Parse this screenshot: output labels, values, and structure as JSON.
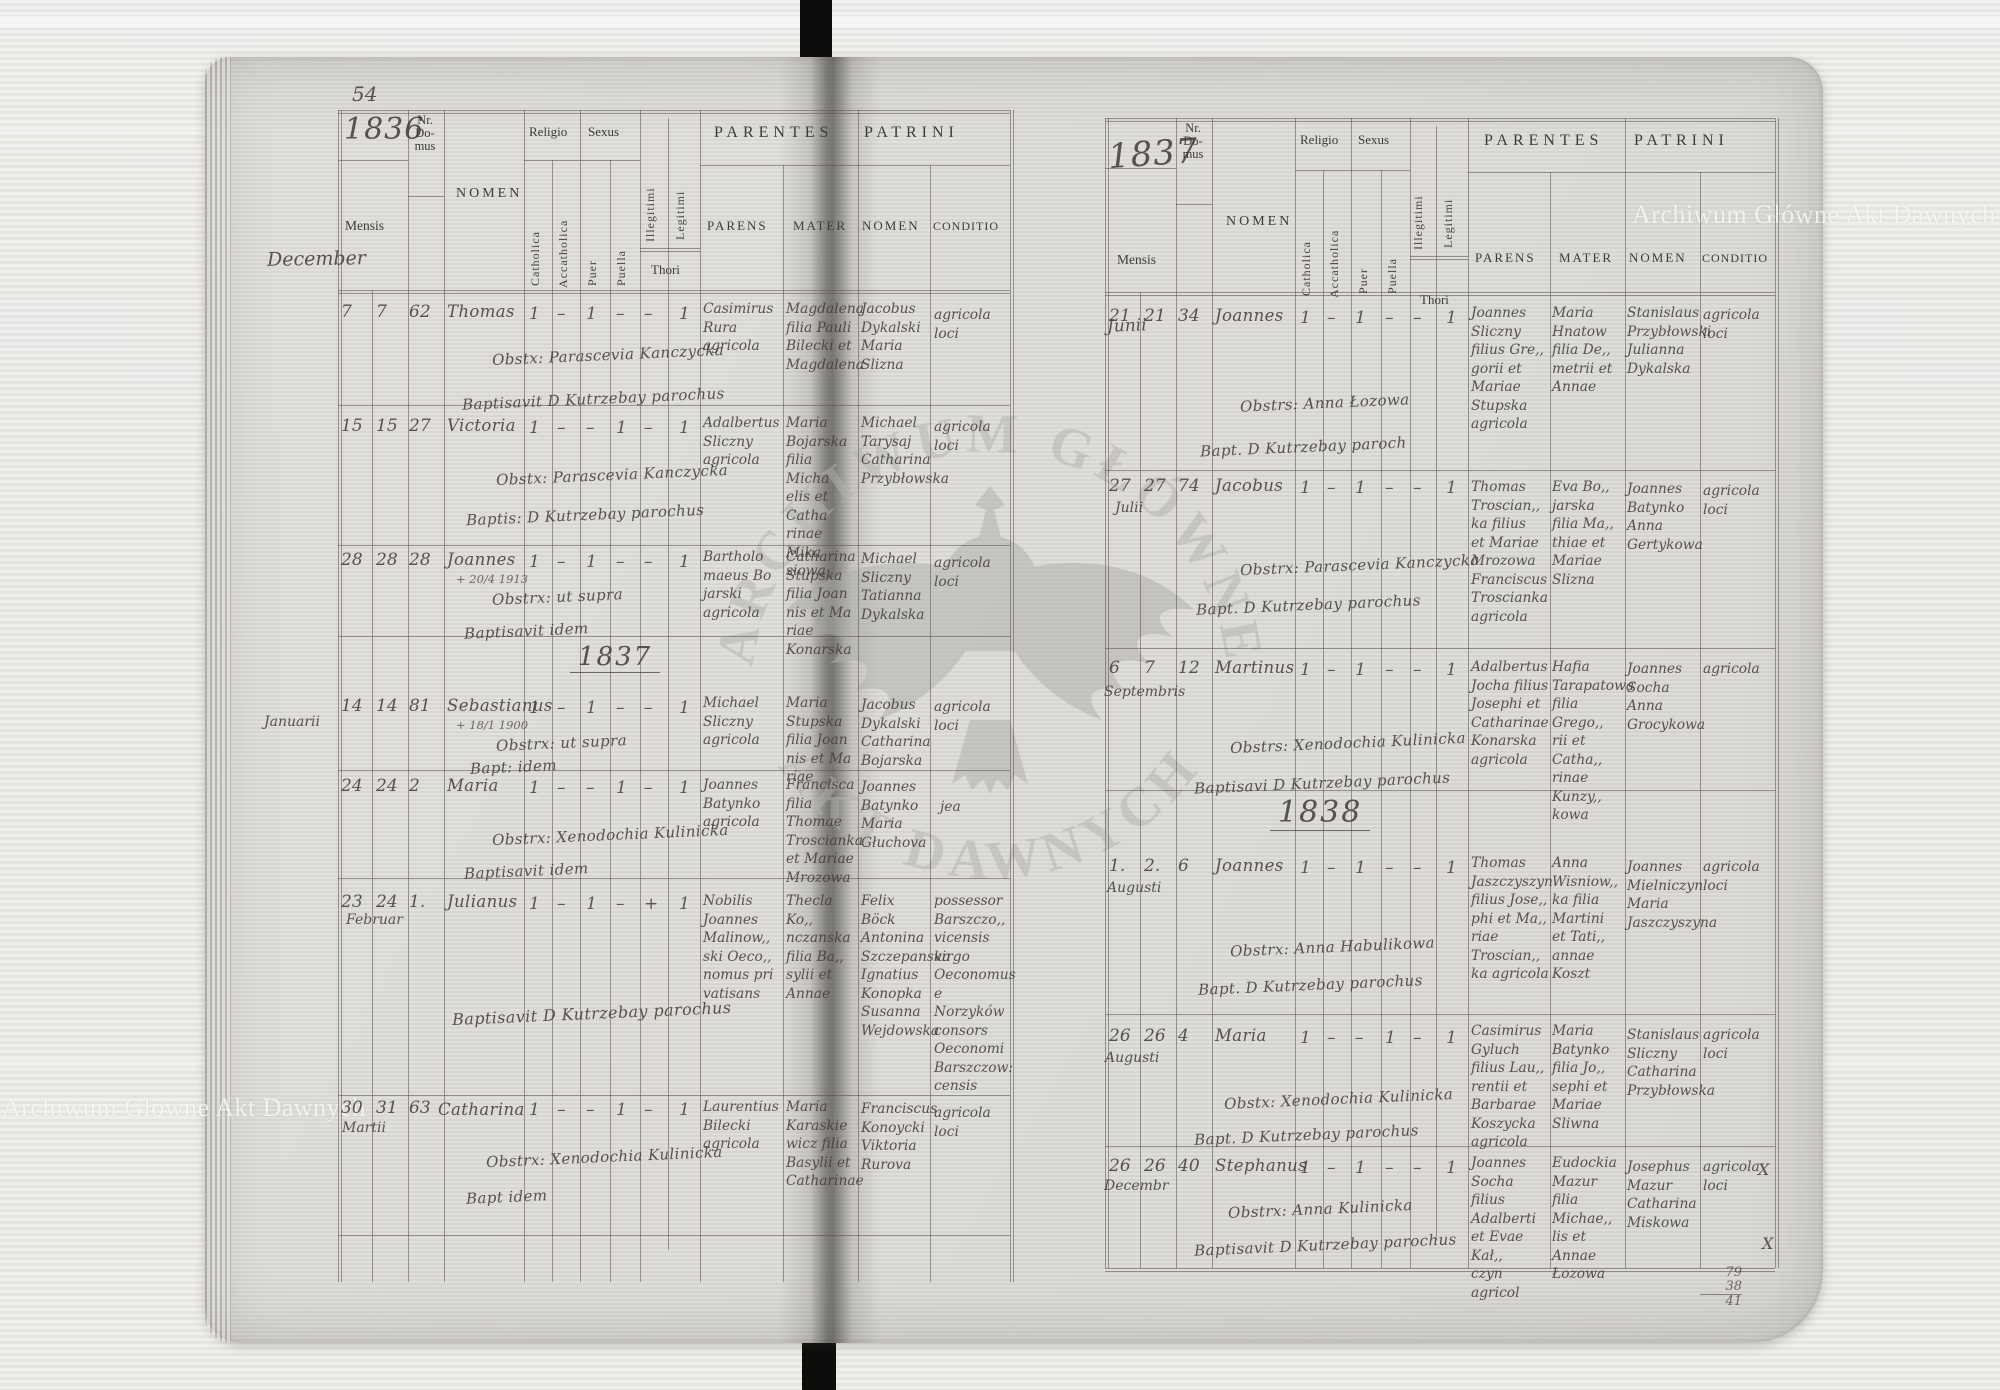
{
  "watermark": {
    "archive_name": "Archiwum Główne Akt Dawnych",
    "seal_text_top": "ARCHIWUM GŁÓWNE",
    "seal_text_bottom": "AKT DAWNYCH"
  },
  "form_labels": {
    "nr_domus": "Nr.\nDo-\nmus",
    "mensis": "Mensis",
    "nomen": "NOMEN",
    "religio": "Religio",
    "sexus": "Sexus",
    "catholica": "Catholica",
    "accatholica": "Accatholica",
    "puer": "Puer",
    "puella": "Puella",
    "illegitimi": "Illegitimi",
    "legitimi": "Legitimi",
    "thori": "Thori",
    "parentes": "PARENTES",
    "patrini": "PATRINI",
    "parens": "PARENS",
    "mater": "MATER",
    "patrini_nomen": "NOMEN",
    "conditio": "CONDITIO"
  },
  "left_page": {
    "page_number": "54",
    "year": "1836",
    "month_heading": "December",
    "year_divider": "1837",
    "records": [
      {
        "d1": "7",
        "d2": "7",
        "nr": "62",
        "nomen": "Thomas",
        "marks": [
          "1",
          "–",
          "1",
          "–",
          "–",
          "1"
        ],
        "obst": "Obstx: Parascevia Kanczycka",
        "bapt": "Baptisavit D Kutrzebay parochus",
        "parens": "Casimirus\nRura\nagricola",
        "mater": "Magdalena\nfilia Pauli\nBilecki et\nMagdalena",
        "patrini": "Jacobus\nDykalski\nMaria\nSlizna",
        "conditio": "agricola\nloci"
      },
      {
        "d1": "15",
        "d2": "15",
        "nr": "27",
        "nomen": "Victoria",
        "marks": [
          "1",
          "–",
          "–",
          "1",
          "–",
          "1"
        ],
        "obst": "Obstx: Parascevia Kanczycka",
        "bapt": "Baptis: D Kutrzebay parochus",
        "parens": "Adalbertus\nSliczny\nagricola",
        "mater": "Maria\nBojarska\nfilia Micha\nelis et Catha\nrinae Mika\nsiowa",
        "patrini": "Michael\nTarysaj\nCatharina\nPrzybłowska",
        "conditio": "agricola\nloci"
      },
      {
        "d1": "28",
        "d2": "28",
        "nr": "28",
        "nomen": "Joannes",
        "note": "+ 20/4 1913",
        "marks": [
          "1",
          "–",
          "1",
          "–",
          "–",
          "1"
        ],
        "obst": "Obstrx: ut supra",
        "bapt": "Baptisavit idem",
        "parens": "Bartholo\nmaeus Bo\njarski\nagricola",
        "mater": "Catharina\nStupska\nfilia Joan\nnis et Ma\nriae Konarska",
        "patrini": "Michael\nSliczny\nTatianna\nDykalska",
        "conditio": "agricola\nloci"
      },
      {
        "d1": "14",
        "d2": "14",
        "month": "Januarii",
        "nr": "81",
        "nomen": "Sebastianus",
        "note": "+ 18/1 1900",
        "marks": [
          "1",
          "–",
          "1",
          "–",
          "–",
          "1"
        ],
        "obst": "Obstrx: ut supra",
        "bapt": "Bapt: idem",
        "parens": "Michael\nSliczny\nagricola",
        "mater": "Maria\nStupska\nfilia Joan\nnis et Ma\nriae",
        "patrini": "Jacobus\nDykalski\nCatharina\nBojarska",
        "conditio": "agricola\nloci"
      },
      {
        "d1": "24",
        "d2": "24",
        "nr": "2",
        "nomen": "Maria",
        "marks": [
          "1",
          "–",
          "–",
          "1",
          "–",
          "1"
        ],
        "obst": "Obstrx: Xenodochia Kulinicka",
        "bapt": "Baptisavit idem",
        "parens": "Joannes\nBatynko\nagricola",
        "mater": "Francisca\nfilia Thomae\nTroscianka\net Mariae\nMrozowa",
        "patrini": "Joannes\nBatynko\nMaria\nGłuchova",
        "conditio": "jea"
      },
      {
        "d1": "23",
        "d2": "24",
        "month": "Februar",
        "nr": "1.",
        "nomen": "Julianus",
        "marks": [
          "1",
          "–",
          "1",
          "–",
          "+",
          "1"
        ],
        "obst": "",
        "bapt": "Baptisavit D Kutrzebay parochus",
        "parens": "Nobilis\nJoannes\nMalinow,,\nski Oeco,,\nnomus pri\nvatisans",
        "mater": "Thecla Ko,,\nnczanska\nfilia Ba,,\nsylii et\nAnnae",
        "patrini": "Felix\nBöck\nAntonina\nSzczepanska\nIgnatius\nKonopka\nSusanna\nWejdowska",
        "conditio": "possessor\nBarszczo,,\nvicensis\nvirgo\nOeconomus\ne Norzyków\nconsors\nOeconomi\nBarszczow:\ncensis"
      },
      {
        "d1": "30",
        "d2": "31",
        "month": "Martii",
        "nr": "63",
        "nomen": "Catharina",
        "marks": [
          "1",
          "–",
          "–",
          "1",
          "–",
          "1"
        ],
        "obst": "Obstrx: Xenodochia Kulinicka",
        "bapt": "Bapt idem",
        "parens": "Laurentius\nBilecki\nagricola",
        "mater": "Maria\nKaraskie\nwicz filia\nBasylii et\nCatharinae",
        "patrini": "Franciscus\nKonoycki\nViktoria\nRurova",
        "conditio": "agricola\nloci"
      }
    ]
  },
  "right_page": {
    "year": "1837",
    "month_heading": "Junii",
    "year_divider": "1838",
    "margin_sum": [
      "79",
      "38",
      "41"
    ],
    "x_marks": [
      "X",
      "X"
    ],
    "records": [
      {
        "d1": "21",
        "d2": "21",
        "nr": "34",
        "nomen": "Joannes",
        "marks": [
          "1",
          "–",
          "1",
          "–",
          "–",
          "1"
        ],
        "obst": "Obstrs: Anna Łozowa",
        "bapt": "Bapt. D Kutrzebay paroch",
        "parens": "Joannes\nSliczny\nfilius Gre,,\ngorii et\nMariae\nStupska\nagricola",
        "mater": "Maria\nHnatow\nfilia De,,\nmetrii et\nAnnae",
        "patrini": "Stanislaus\nPrzybłowski\nJulianna\nDykalska",
        "conditio": "agricola\nloci"
      },
      {
        "d1": "27",
        "d2": "27",
        "month": "Julii",
        "nr": "74",
        "nomen": "Jacobus",
        "marks": [
          "1",
          "–",
          "1",
          "–",
          "–",
          "1"
        ],
        "obst": "Obstrx: Parascevia Kanczycka",
        "bapt": "Bapt. D Kutrzebay parochus",
        "parens": "Thomas\nTroscian,,\nka filius\net Mariae\nMrozowa\nFranciscus\nTroscianka\nagricola",
        "mater": "Eva Bo,,\njarska\nfilia Ma,,\nthiae et\nMariae\nSlizna",
        "patrini": "Joannes\nBatynko\nAnna\nGertykowa",
        "conditio": "agricola\nloci"
      },
      {
        "d1": "6",
        "d2": "7",
        "month": "Septembris",
        "nr": "12",
        "nomen": "Martinus",
        "marks": [
          "1",
          "–",
          "1",
          "–",
          "–",
          "1"
        ],
        "obst": "Obstrs: Xenodochia Kulinicka",
        "bapt": "Baptisavi D Kutrzebay parochus",
        "parens": "Adalbertus\nJocha filius\nJosephi et\nCatharinae\nKonarska\nagricola",
        "mater": "Hafia\nTarapatowa\nfilia Grego,,\nrii et Catha,,\nrinae Kunzy,,\nkowa",
        "patrini": "Joannes\nSocha\nAnna\nGrocykowa",
        "conditio": "agricola"
      },
      {
        "d1": "1.",
        "d2": "2.",
        "month": "Augusti",
        "nr": "6",
        "nomen": "Joannes",
        "marks": [
          "1",
          "–",
          "1",
          "–",
          "–",
          "1"
        ],
        "obst": "Obstrx: Anna Habulikowa",
        "bapt": "Bapt. D Kutrzebay parochus",
        "parens": "Thomas\nJaszczyszyn\nfilius Jose,,\nphi et Ma,,\nriae Troscian,,\nka agricola",
        "mater": "Anna\nWisniow,,\nka filia\nMartini\net Tati,,\nannae\nKoszt",
        "patrini": "Joannes\nMielniczyn\nMaria\nJaszczyszyna",
        "conditio": "agricola\nloci"
      },
      {
        "d1": "26",
        "d2": "26",
        "month": "Augusti",
        "nr": "4",
        "nomen": "Maria",
        "marks": [
          "1",
          "–",
          "–",
          "1",
          "–",
          "1"
        ],
        "obst": "Obstx: Xenodochia Kulinicka",
        "bapt": "Bapt. D Kutrzebay parochus",
        "parens": "Casimirus\nGyluch\nfilius Lau,,\nrentii et\nBarbarae\nKoszycka\nagricola",
        "mater": "Maria\nBatynko\nfilia Jo,,\nsephi et\nMariae\nSliwna",
        "patrini": "Stanislaus\nSliczny\nCatharina\nPrzybłowska",
        "conditio": "agricola\nloci"
      },
      {
        "d1": "26",
        "d2": "26",
        "month": "Decembr",
        "nr": "40",
        "nomen": "Stephanus",
        "marks": [
          "1",
          "–",
          "1",
          "–",
          "–",
          "1"
        ],
        "obst": "Obstrx: Anna Kulinicka",
        "bapt": "Baptisavit D Kutrzebay parochus",
        "parens": "Joannes\nSocha filius\nAdalberti\net Evae Kał,,\nczyn agricol",
        "mater": "Eudockia\nMazur\nfilia Michae,,\nlis et Annae\nŁozowa",
        "patrini": "Josephus\nMazur\nCatharina\nMiskowa",
        "conditio": "agricola\nloci"
      }
    ]
  }
}
